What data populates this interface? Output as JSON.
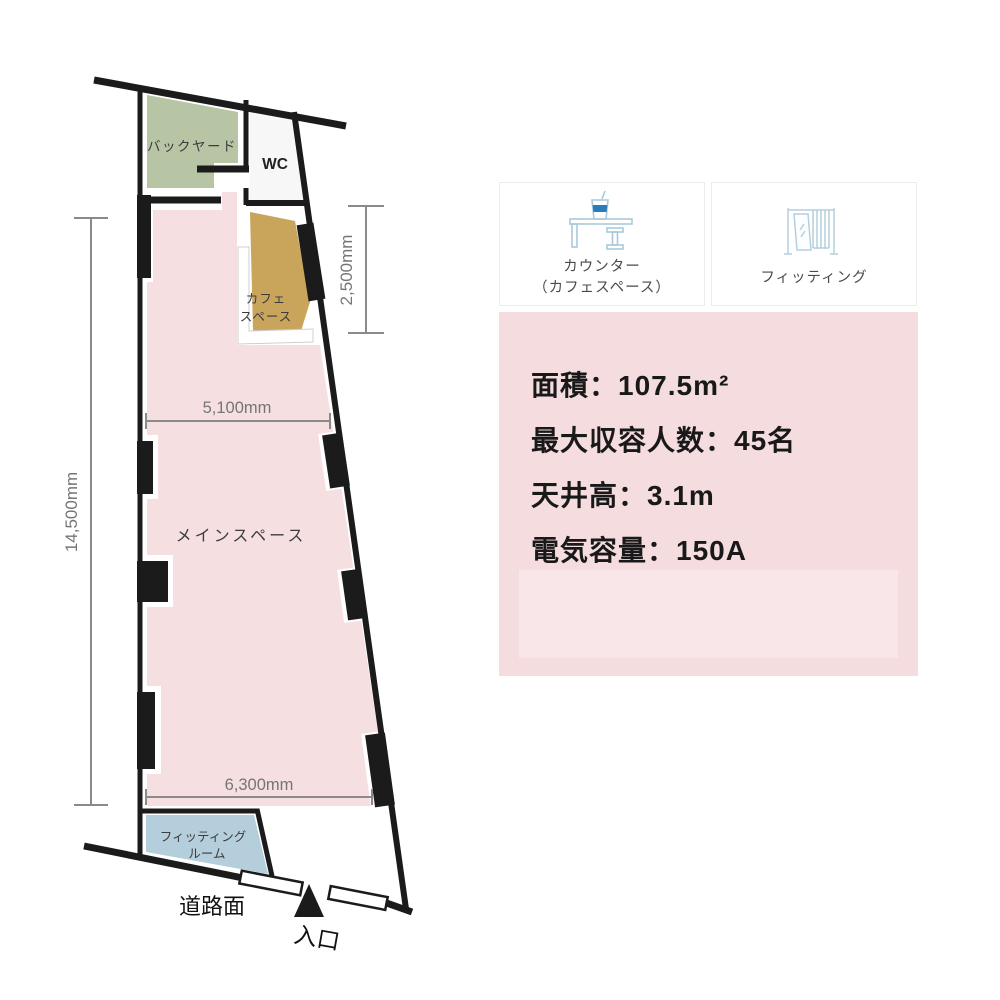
{
  "floor_plan": {
    "rooms": {
      "backyard": {
        "label": "バックヤード",
        "color": "#b7c5a5"
      },
      "wc": {
        "label": "WC",
        "color": "#f7f7f8"
      },
      "cafe": {
        "label_line1": "カフェ",
        "label_line2": "スペース",
        "color": "#c9a55c"
      },
      "main": {
        "label": "メインスペース",
        "color": "#f5dfe1"
      },
      "fitting_room": {
        "label_line1": "フィッティング",
        "label_line2": "ルーム",
        "color": "#b5cedb"
      }
    },
    "dimensions": {
      "left": "14,500mm",
      "top_right": "2,500mm",
      "middle_width": "5,100mm",
      "bottom_width": "6,300mm"
    },
    "road_label": "道路面",
    "entrance_label": "入口",
    "wall_color": "#1b1b1b",
    "dimension_color": "#8a8a8a"
  },
  "features": {
    "counter_card": {
      "icon": "counter-icon",
      "label_line1": "カウンター",
      "label_line2": "（カフェスペース）"
    },
    "fitting_card": {
      "icon": "fitting-icon",
      "label": "フィッティング"
    },
    "icon_color": "#a9c9da",
    "icon_accent": "#2b7cba"
  },
  "specs": {
    "background": "#f5dcdf",
    "items": [
      {
        "label": "面積",
        "value": "107.5m²",
        "text": "面積：107.5m²"
      },
      {
        "label": "最大収容人数",
        "value": "45名",
        "text": "最大収容人数：45名"
      },
      {
        "label": "天井高",
        "value": "3.1m",
        "text": "天井高：3.1m"
      },
      {
        "label": "電気容量",
        "value": "150A",
        "text": "電気容量：150A"
      }
    ]
  }
}
